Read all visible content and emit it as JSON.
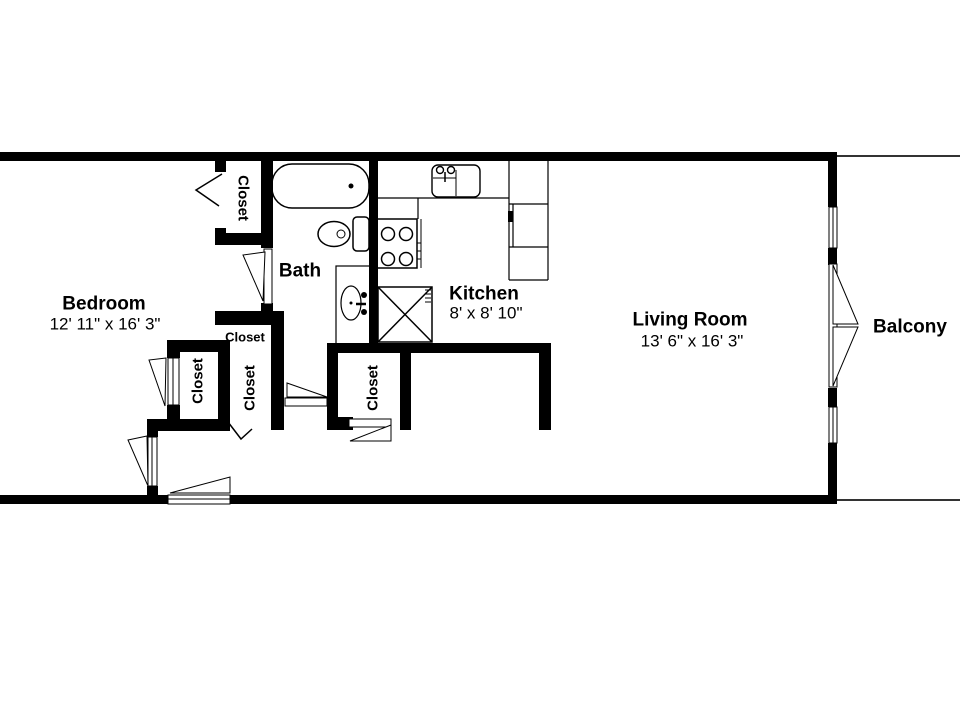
{
  "floorplan": {
    "rooms": {
      "bedroom": {
        "label": "Bedroom",
        "dims": "12' 11\" x 16' 3\""
      },
      "bath": {
        "label": "Bath"
      },
      "kitchen": {
        "label": "Kitchen",
        "dims": "8' x 8' 10\""
      },
      "living_room": {
        "label": "Living Room",
        "dims": "13' 6\" x 16' 3\""
      },
      "balcony": {
        "label": "Balcony"
      }
    },
    "closets": {
      "bedroom_closet": {
        "label": "Closet"
      },
      "hall_small": {
        "label": "Closet"
      },
      "closet_left": {
        "label": "Closet"
      },
      "closet_middle": {
        "label": "Closet"
      },
      "closet_hall": {
        "label": "Closet"
      }
    },
    "colors": {
      "wall": "#000000",
      "background": "#ffffff",
      "line": "#1a1a1a"
    }
  }
}
